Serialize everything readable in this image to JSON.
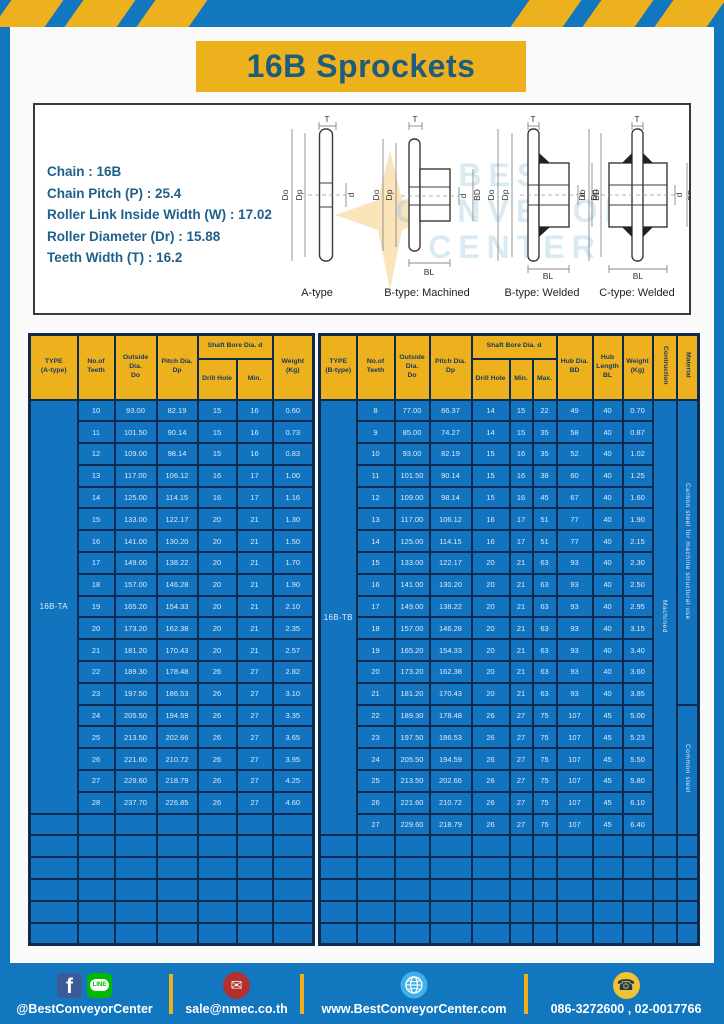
{
  "title": "16B Sprockets",
  "specs": {
    "lines": [
      "Chain : 16B",
      "Chain Pitch (P) : 25.4",
      "Roller Link Inside Width (W) : 17.02",
      "Roller Diameter (Dr) : 15.88",
      "Teeth Width (T) : 16.2"
    ]
  },
  "diagrams": {
    "captions": [
      "A-type",
      "B-type: Machined",
      "B-type: Welded",
      "C-type: Welded"
    ],
    "dims": {
      "t": "T",
      "do": "Do",
      "dp": "Dp",
      "d": "d",
      "bd": "BD",
      "bl": "BL"
    }
  },
  "watermark": {
    "lines": [
      "BEST",
      "CONVEYOR",
      "CENTER"
    ]
  },
  "table_a": {
    "headers": {
      "type": "TYPE\n(A-type)",
      "teeth": "No.of\nTeeth",
      "outside": "Outside\nDia.\nDo",
      "pitch": "Pitch Dia.\nDp",
      "shaft_group": "Shaft Bore Dia. d",
      "drill": "Drill Hole",
      "min": "Min.",
      "weight": "Weight\n(Kg)"
    },
    "type_label": "16B-TA",
    "rows": [
      [
        "10",
        "93.00",
        "82.19",
        "15",
        "16",
        "0.60"
      ],
      [
        "11",
        "101.50",
        "90.14",
        "15",
        "16",
        "0.73"
      ],
      [
        "12",
        "109.00",
        "98.14",
        "15",
        "16",
        "0.83"
      ],
      [
        "13",
        "117.00",
        "106.12",
        "16",
        "17",
        "1.00"
      ],
      [
        "14",
        "125.00",
        "114.15",
        "16",
        "17",
        "1.16"
      ],
      [
        "15",
        "133.00",
        "122.17",
        "20",
        "21",
        "1.30"
      ],
      [
        "16",
        "141.00",
        "130.20",
        "20",
        "21",
        "1.50"
      ],
      [
        "17",
        "149.00",
        "138.22",
        "20",
        "21",
        "1.70"
      ],
      [
        "18",
        "157.00",
        "146.28",
        "20",
        "21",
        "1.90"
      ],
      [
        "19",
        "165.20",
        "154.33",
        "20",
        "21",
        "2.10"
      ],
      [
        "20",
        "173.20",
        "162.38",
        "20",
        "21",
        "2.35"
      ],
      [
        "21",
        "181.20",
        "170.43",
        "20",
        "21",
        "2.57"
      ],
      [
        "22",
        "189.30",
        "178.48",
        "26",
        "27",
        "2.82"
      ],
      [
        "23",
        "197.50",
        "186.53",
        "26",
        "27",
        "3.10"
      ],
      [
        "24",
        "205.50",
        "194.59",
        "26",
        "27",
        "3.35"
      ],
      [
        "25",
        "213.50",
        "202.66",
        "26",
        "27",
        "3.65"
      ],
      [
        "26",
        "221.60",
        "210.72",
        "26",
        "27",
        "3.95"
      ],
      [
        "27",
        "229.60",
        "218.79",
        "26",
        "27",
        "4.25"
      ],
      [
        "28",
        "237.70",
        "226.85",
        "26",
        "27",
        "4.60"
      ]
    ],
    "empty_rows": 6
  },
  "table_b": {
    "headers": {
      "type": "TYPE\n(B-type)",
      "teeth": "No.of\nTeeth",
      "outside": "Outside\nDia.\nDo",
      "pitch": "Pitch Dia.\nDp",
      "shaft_group": "Shaft Bore Dia. d",
      "drill": "Drill Hole",
      "min": "Min.",
      "max": "Max.",
      "hub_dia": "Hub Dia.\nBD",
      "hub_len": "Hub\nLength\nBL",
      "weight": "Weight\n(Kg)",
      "construction": "Contruction",
      "material": "Material"
    },
    "type_label": "16B-TB",
    "construction": "Machined",
    "materials": [
      {
        "text": "Carbon steel for machine structural use",
        "rows": 14
      },
      {
        "text": "Common steel",
        "rows": 6
      }
    ],
    "rows": [
      [
        "8",
        "77.00",
        "66.37",
        "14",
        "15",
        "22",
        "49",
        "40",
        "0.70"
      ],
      [
        "9",
        "85.00",
        "74.27",
        "14",
        "15",
        "35",
        "58",
        "40",
        "0.87"
      ],
      [
        "10",
        "93.00",
        "82.19",
        "15",
        "16",
        "35",
        "52",
        "40",
        "1.02"
      ],
      [
        "11",
        "101.50",
        "90.14",
        "15",
        "16",
        "38",
        "60",
        "40",
        "1.25"
      ],
      [
        "12",
        "109.00",
        "98.14",
        "15",
        "16",
        "45",
        "67",
        "40",
        "1.60"
      ],
      [
        "13",
        "117.00",
        "106.12",
        "16",
        "17",
        "51",
        "77",
        "40",
        "1.90"
      ],
      [
        "14",
        "125.00",
        "114.15",
        "16",
        "17",
        "51",
        "77",
        "40",
        "2.15"
      ],
      [
        "15",
        "133.00",
        "122.17",
        "20",
        "21",
        "63",
        "93",
        "40",
        "2.30"
      ],
      [
        "16",
        "141.00",
        "130.20",
        "20",
        "21",
        "63",
        "93",
        "40",
        "2.50"
      ],
      [
        "17",
        "149.00",
        "138.22",
        "20",
        "21",
        "63",
        "93",
        "40",
        "2.95"
      ],
      [
        "18",
        "157.00",
        "146.28",
        "20",
        "21",
        "63",
        "93",
        "40",
        "3.15"
      ],
      [
        "19",
        "165.20",
        "154.33",
        "20",
        "21",
        "63",
        "93",
        "40",
        "3.40"
      ],
      [
        "20",
        "173.20",
        "162.38",
        "20",
        "21",
        "63",
        "93",
        "40",
        "3.60"
      ],
      [
        "21",
        "181.20",
        "170.43",
        "20",
        "21",
        "63",
        "93",
        "40",
        "3.85"
      ],
      [
        "22",
        "189.30",
        "178.48",
        "26",
        "27",
        "75",
        "107",
        "45",
        "5.00"
      ],
      [
        "23",
        "197.50",
        "186.53",
        "26",
        "27",
        "75",
        "107",
        "45",
        "5.23"
      ],
      [
        "24",
        "205.50",
        "194.59",
        "26",
        "27",
        "75",
        "107",
        "45",
        "5.50"
      ],
      [
        "25",
        "213.50",
        "202.66",
        "26",
        "27",
        "75",
        "107",
        "45",
        "5.80"
      ],
      [
        "26",
        "221.60",
        "210.72",
        "26",
        "27",
        "75",
        "107",
        "45",
        "6.10"
      ],
      [
        "27",
        "229.60",
        "218.79",
        "26",
        "27",
        "75",
        "107",
        "45",
        "6.40"
      ]
    ],
    "empty_rows": 5
  },
  "footer": {
    "line_label": "LINE",
    "items": [
      {
        "icon": "facebook,line",
        "text": "@BestConveyorCenter"
      },
      {
        "icon": "email",
        "text": "sale@nmec.co.th"
      },
      {
        "icon": "globe",
        "text": "www.BestConveyorCenter.com"
      },
      {
        "icon": "phone",
        "text": "086-3272600 , 02-0017766"
      }
    ]
  },
  "colors": {
    "blue": "#1377bf",
    "yellow": "#eeb11e",
    "table_cell_blue": "#1273bf",
    "border_navy": "#0d2b50",
    "title_text": "#1e5b7d"
  }
}
